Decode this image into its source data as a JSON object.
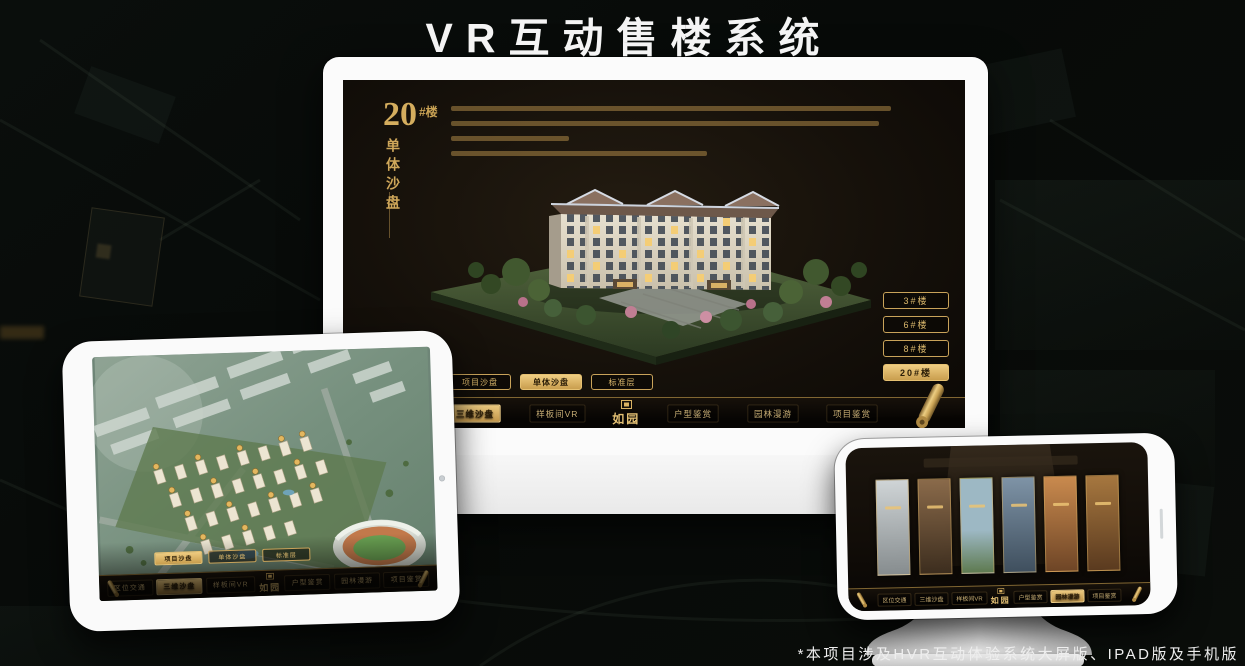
{
  "page": {
    "title": "VR互动售楼系统",
    "footnote": "*本项目涉及HVR互动体验系统大屏版、IPAD版及手机版"
  },
  "colors": {
    "gold": "#d2ab5f",
    "gold_bright": "#eac97e",
    "gold_dark": "#8a6a33",
    "screen_bg": "#171007",
    "device_frame": "#fafafa"
  },
  "desktop_app": {
    "hero": {
      "number": "20",
      "suffix": "#楼",
      "subtitle": "单体沙盘"
    },
    "floor_buttons": [
      {
        "label": "3#楼",
        "selected": false
      },
      {
        "label": "6#楼",
        "selected": false
      },
      {
        "label": "8#楼",
        "selected": false
      },
      {
        "label": "20#楼",
        "selected": true
      }
    ],
    "view_tabs": [
      {
        "label": "项目沙盘",
        "selected": false
      },
      {
        "label": "单体沙盘",
        "selected": true
      },
      {
        "label": "标准层",
        "selected": false
      }
    ],
    "nav": {
      "logo": "如园",
      "items": [
        {
          "label": "区位交通",
          "selected": false
        },
        {
          "label": "三维沙盘",
          "selected": true
        },
        {
          "label": "样板间VR",
          "selected": false
        },
        {
          "label": "户型鉴赏",
          "selected": false
        },
        {
          "label": "园林漫游",
          "selected": false
        },
        {
          "label": "项目鉴赏",
          "selected": false
        }
      ]
    }
  },
  "ipad_app": {
    "view_tabs": [
      {
        "label": "项目沙盘",
        "selected": true
      },
      {
        "label": "单体沙盘",
        "selected": false
      },
      {
        "label": "标准层",
        "selected": false
      }
    ],
    "nav": {
      "logo": "如园",
      "items": [
        {
          "label": "区位交通",
          "selected": false
        },
        {
          "label": "三维沙盘",
          "selected": true
        },
        {
          "label": "样板间VR",
          "selected": false
        },
        {
          "label": "户型鉴赏",
          "selected": false
        },
        {
          "label": "园林漫游",
          "selected": false
        },
        {
          "label": "项目鉴赏",
          "selected": false
        }
      ]
    }
  },
  "phone_app": {
    "nav": {
      "logo": "如园",
      "items": [
        {
          "label": "区位交通",
          "selected": false
        },
        {
          "label": "三维沙盘",
          "selected": false
        },
        {
          "label": "样板间VR",
          "selected": false
        },
        {
          "label": "户型鉴赏",
          "selected": false
        },
        {
          "label": "园林漫游",
          "selected": true
        },
        {
          "label": "项目鉴赏",
          "selected": false
        }
      ]
    }
  }
}
